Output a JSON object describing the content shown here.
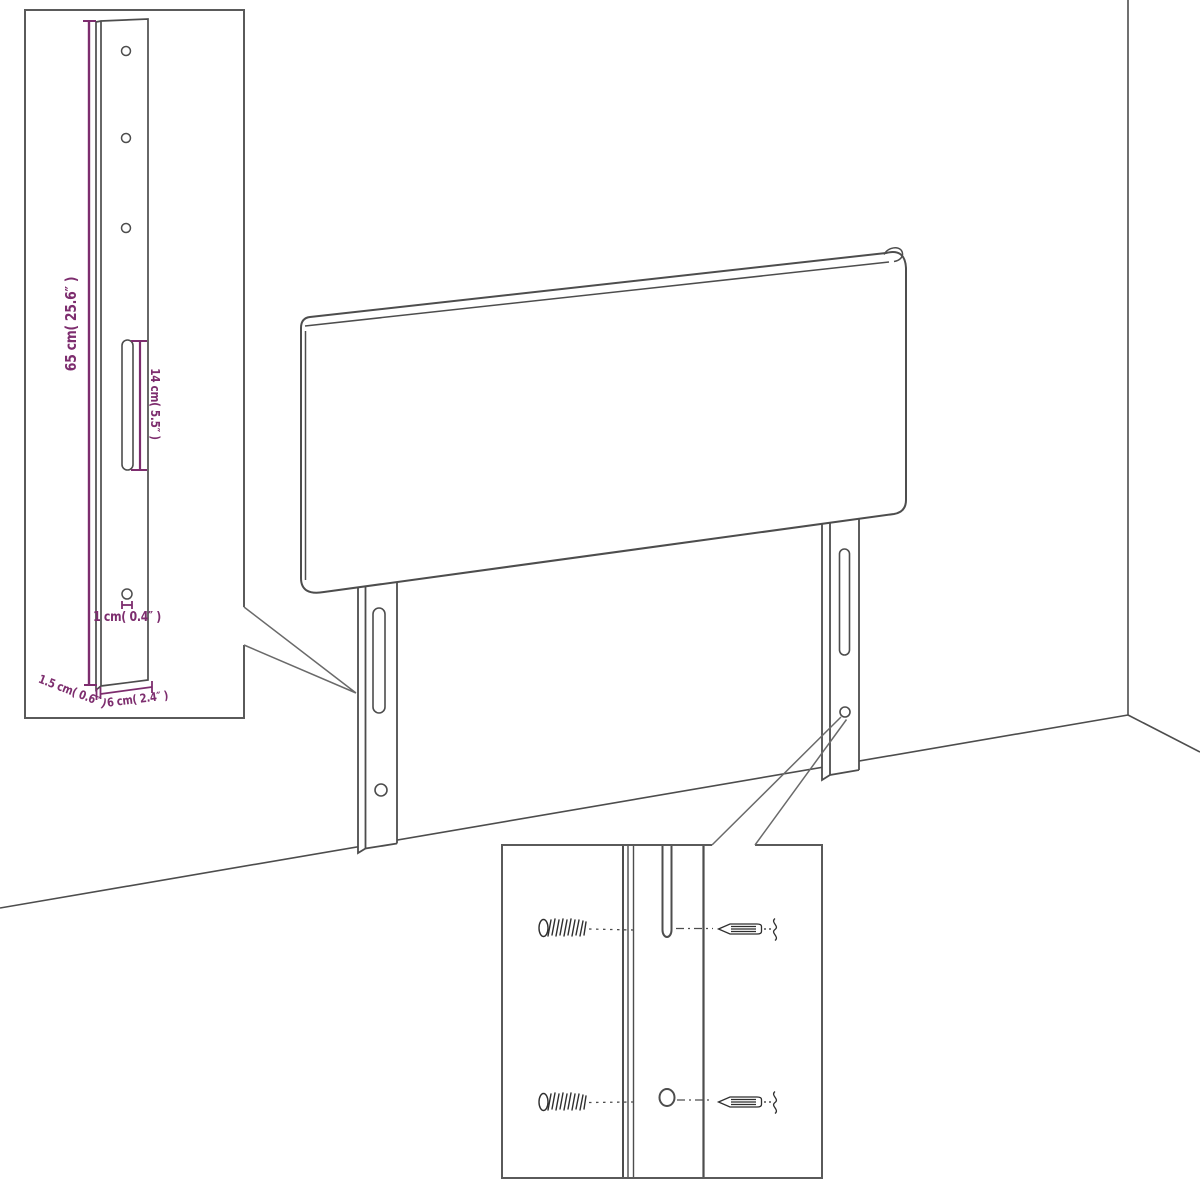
{
  "page": {
    "background": "#ffffff"
  },
  "diagram": {
    "kind": "furniture-assembly-dimension-diagram",
    "subject": "upholstered headboard with two mounting legs shown in a room corner, with magnified leg and mounting-hardware insets",
    "colors": {
      "line": "#4d4d4d",
      "inset_border": "#5a5a5a",
      "dimension": "#7d2d6e",
      "background": "#ffffff"
    },
    "leg_inset": {
      "height_label": "65 cm( 25.6″ )",
      "slot_label": "14 cm( 5.5″ )",
      "hole_label": "1 cm( 0.4″ )",
      "thickness_label": "1.5 cm( 0.6″ )",
      "width_label": "6 cm( 2.4″ )",
      "screw_hole_count": 3
    },
    "hardware_inset": {
      "left_screws": [
        "wood-screw",
        "wood-screw"
      ],
      "right_screws": [
        "machine-screw",
        "machine-screw"
      ]
    }
  }
}
